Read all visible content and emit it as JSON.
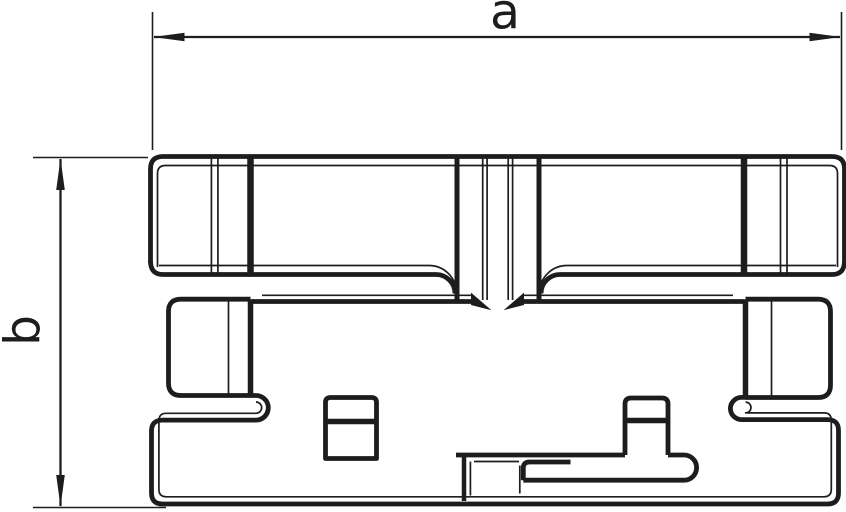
{
  "drawing": {
    "type": "technical-line-drawing",
    "dimension_labels": {
      "horizontal": "a",
      "vertical": "b"
    },
    "colors": {
      "background": "#ffffff",
      "line": "#1d1d1d"
    }
  }
}
